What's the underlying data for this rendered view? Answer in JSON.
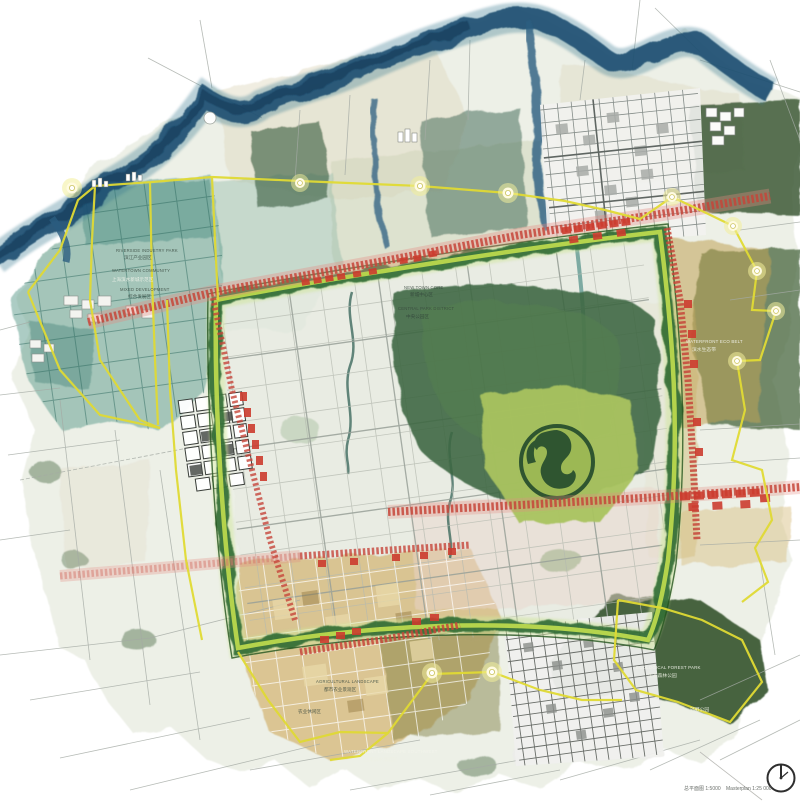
{
  "map_title": "watercolor-urban-masterplan",
  "labels": [
    {
      "id": "nw-1",
      "text": "RIVERSIDE INDUSTRY PARK"
    },
    {
      "id": "nw-1-zh",
      "text": "滨江产业园区"
    },
    {
      "id": "nw-2",
      "text": "WATERTOWN COMMUNITY"
    },
    {
      "id": "nw-3",
      "text": "上海滨水新城示范区"
    },
    {
      "id": "nw-4",
      "text": "MIXED DEVELOPMENT"
    },
    {
      "id": "nw-4-zh",
      "text": "综合发展区"
    },
    {
      "id": "c-1",
      "text": "NEW TOWN CORE"
    },
    {
      "id": "c-1-zh",
      "text": "新城中心区"
    },
    {
      "id": "c-2",
      "text": "CENTRAL PARK DISTRICT"
    },
    {
      "id": "c-2-zh",
      "text": "中央公园区"
    },
    {
      "id": "e-1",
      "text": "WATERFRONT ECO BELT"
    },
    {
      "id": "e-1-zh",
      "text": "滨水生态带"
    },
    {
      "id": "s-1",
      "text": "AGRICULTURAL LANDSCAPE"
    },
    {
      "id": "s-1-zh",
      "text": "都市农业景观区"
    },
    {
      "id": "s-2-zh",
      "text": "农业休闲区"
    },
    {
      "id": "s-3",
      "text": "WATERFRONT LANDSCAPE SOUTHWEST"
    },
    {
      "id": "s-3-zh",
      "text": "西南滨水景观区"
    },
    {
      "id": "se-1",
      "text": "ECOLOGICAL FOREST PARK"
    },
    {
      "id": "se-1-zh",
      "text": "生态森林公园"
    },
    {
      "id": "se-2-zh",
      "text": "郊野公园"
    }
  ],
  "footer": {
    "scale_left": "总平面图 1:5000",
    "scale_right": "Masterplan 1:25 000"
  },
  "icons": {
    "north": "compass-dial-icon"
  },
  "colors": {
    "river_blue": "#1c4e70",
    "wetland_teal": "#5e9c90",
    "ring_green": "#2f6d36",
    "ring_lime": "#c8dd55",
    "corridor_red": "#c6453a",
    "boundary_yellow": "#e0da34",
    "farmland_gold": "#cfa95c",
    "forest_green": "#3b5a33",
    "town_grey": "#7b817c"
  }
}
